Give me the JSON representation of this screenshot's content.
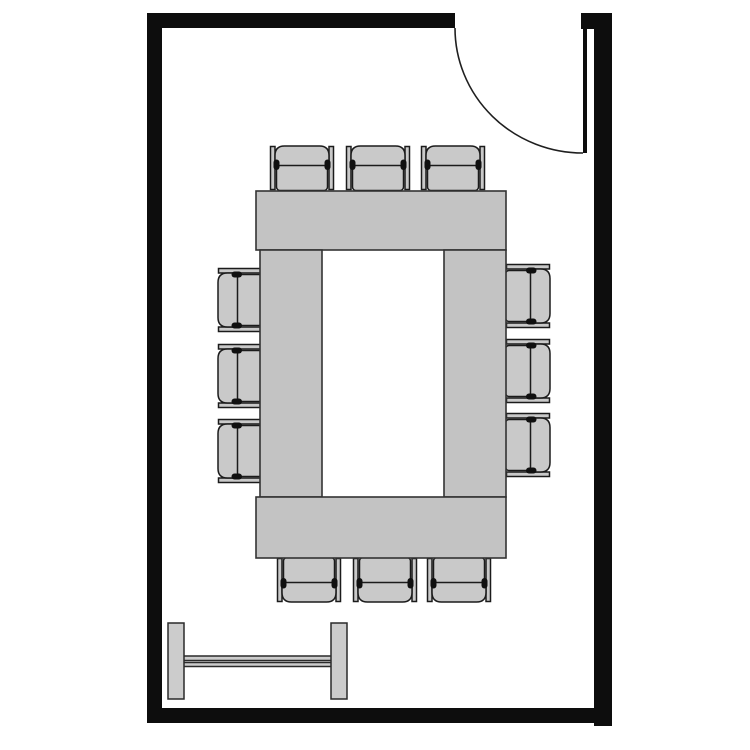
{
  "colors": {
    "background": "#ffffff",
    "wall": "#0d0d0d",
    "door_stroke": "#1f1f1f",
    "table_fill": "#c3c3c3",
    "table_stroke": "#333333",
    "chair_fill": "#c9c9c9",
    "chair_stroke": "#1b1b1b",
    "chair_accent": "#101010",
    "board_fill": "#cccccc",
    "board_stroke": "#2a2a2a"
  },
  "scene": {
    "kind": "room-floor-plan",
    "room": {
      "shape": "rectangle",
      "walls": 4,
      "door": {
        "count": 1,
        "position": "top-right",
        "state": "open",
        "symbol": "leaf-with-quarter-circle-swing-arc"
      }
    },
    "furniture": [
      {
        "name": "conference-table",
        "shape": "hollow-rectangle",
        "sections": 4
      },
      {
        "name": "chairs",
        "count": 12,
        "per_side": {
          "top": 3,
          "bottom": 3,
          "left": 3,
          "right": 3
        }
      },
      {
        "name": "freestanding-board",
        "position": "bottom-left",
        "parts": [
          "left-leg",
          "right-leg",
          "double-rail"
        ]
      }
    ]
  }
}
